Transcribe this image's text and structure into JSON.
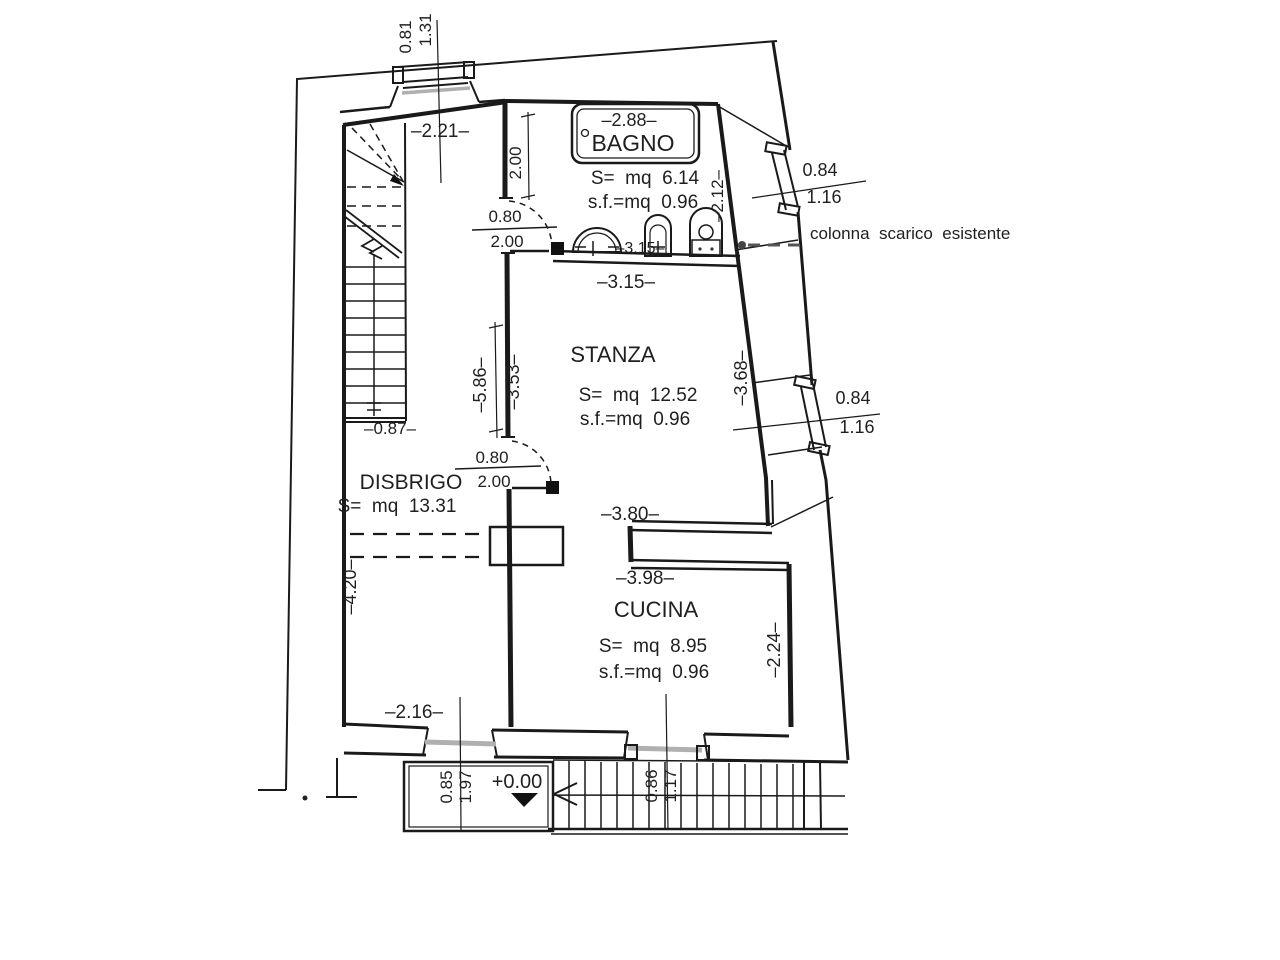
{
  "rooms": {
    "bagno": {
      "name": "BAGNO",
      "width_dim": "–2.88–",
      "area": "S=  mq  6.14",
      "sf": "s.f.=mq  0.96"
    },
    "stanza": {
      "name": "STANZA",
      "area": "S=  mq  12.52",
      "sf": "s.f.=mq  0.96"
    },
    "disbrigo": {
      "name": "DISBRIGO",
      "area": "S=  mq  13.31"
    },
    "cucina": {
      "name": "CUCINA",
      "area": "S=  mq  8.95",
      "sf": "s.f.=mq  0.96"
    }
  },
  "annotations": {
    "colonna": "colonna  scarico  esistente",
    "level": "+0.00"
  },
  "dims": {
    "top_win_a": "0.81",
    "top_win_b": "1.31",
    "d221": "–2.21–",
    "corridor_h": "2.00",
    "bagno_door_w": "0.80",
    "bagno_door_h": "2.00",
    "d212": "–2.12–",
    "win1_w": "0.84",
    "win1_h": "1.16",
    "d315_inner": "–3.15–",
    "d315": "–3.15–",
    "d586": "–5.86–",
    "d353": "–3.53–",
    "d368": "–3.68–",
    "win2_w": "0.84",
    "win2_h": "1.16",
    "d087": "–0.87–",
    "stanza_door_w": "0.80",
    "stanza_door_h": "2.00",
    "d380": "–3.80–",
    "d420": "–4.20–",
    "d398": "–3.98–",
    "d224": "–2.24–",
    "d216": "–2.16–",
    "door1_w": "0.85",
    "door1_h": "1.97",
    "win3_w": "0.86",
    "win3_h": "1.17"
  }
}
